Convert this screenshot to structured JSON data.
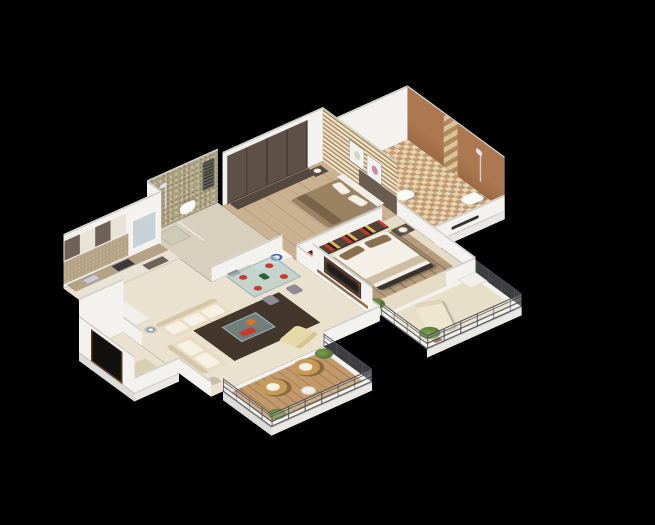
{
  "scene": {
    "name": "isometric-3d-floor-plan-render",
    "description": "3D cutaway floor plan of a 2-bedroom apartment on a black background",
    "background": "#000000"
  },
  "palette": {
    "bg": "#000000",
    "wall": "#f4f2ee",
    "rim": "#cfcdc8",
    "floor": "#eae2cf",
    "floorBed": "#e6dcc6",
    "floorBath": "#d8d0bd",
    "wood": "#c9b192",
    "deck": "#c2996a",
    "mosaic": "#aea284",
    "slatLight": "#efe2c8",
    "slatDark": "#a98d66",
    "terracotta": "#ad7850",
    "wardrobe": "#5d5147",
    "cabDark": "#6e6157",
    "cabCream": "#e9e3d6",
    "counter": "#b3a284",
    "sofa": "#e8dcc4",
    "rug": "#43372b",
    "white": "#f4f0e8",
    "pillow": "#8a6e50",
    "duvet": "#9a8262",
    "red": "#c53b2f",
    "orange": "#d9752b",
    "plant": "#5e7d3c",
    "plantDark": "#3f5722",
    "metal": "#72767a",
    "tv": "#1d1d1f",
    "door": "#5b3a24",
    "blue": "#3f63b0",
    "check1": "#c59a6e",
    "check2": "#e3d4b4",
    "glass": "rgba(160,195,200,0.5)",
    "railGlass": "rgba(235,240,243,0.12)"
  },
  "rooms": [
    {
      "name": "entrance-foyer",
      "items": [
        "open-wooden-door",
        "doormat"
      ]
    },
    {
      "name": "kitchen",
      "items": [
        "upper-cabinets-brown-cream",
        "tan-backsplash",
        "counter-with-sink-and-hob",
        "window",
        "tall-white-unit"
      ]
    },
    {
      "name": "common-bathroom",
      "items": [
        "mosaic-feature-wall",
        "shower",
        "wall-hung-toilet",
        "louver-vent",
        "wash-basin-counter-blue-bowl"
      ]
    },
    {
      "name": "dining-area",
      "items": [
        "glass-dining-table",
        "four-grey-chairs",
        "red-place-settings",
        "bottles"
      ]
    },
    {
      "name": "living-room",
      "items": [
        "three-seat-cream-sofa",
        "two-seat-cream-sofa",
        "glass-coffee-table",
        "dark-brown-rug",
        "floor-lamp",
        "side-stool",
        "accent-armchair",
        "tv-partition-with-shelf"
      ]
    },
    {
      "name": "master-bedroom",
      "items": [
        "double-bed-white-duvet-brown-pillows",
        "dark-sideboard-with-books",
        "nightstand",
        "table-lamp",
        "plank-rug",
        "potted-plant"
      ]
    },
    {
      "name": "bedroom-2",
      "items": [
        "dark-wardrobe",
        "wood-slat-accent-wall",
        "two-framed-artworks",
        "double-bed-brown-duvet",
        "white-headboard",
        "nightstand-lamp"
      ]
    },
    {
      "name": "master-bathroom",
      "items": [
        "terracotta-tile-wall",
        "patterned-accent-tile-strip",
        "shower",
        "pedestal-sink",
        "toilet",
        "checkered-floor",
        "towel-rail"
      ]
    },
    {
      "name": "living-balcony",
      "items": [
        "wood-deck",
        "two-rattan-egg-chairs",
        "round-table",
        "potted-plants",
        "metal-railing"
      ]
    },
    {
      "name": "bedroom-balcony",
      "items": [
        "chaise-lounge",
        "potted-plant",
        "white-planter-box",
        "metal-railing"
      ]
    }
  ]
}
